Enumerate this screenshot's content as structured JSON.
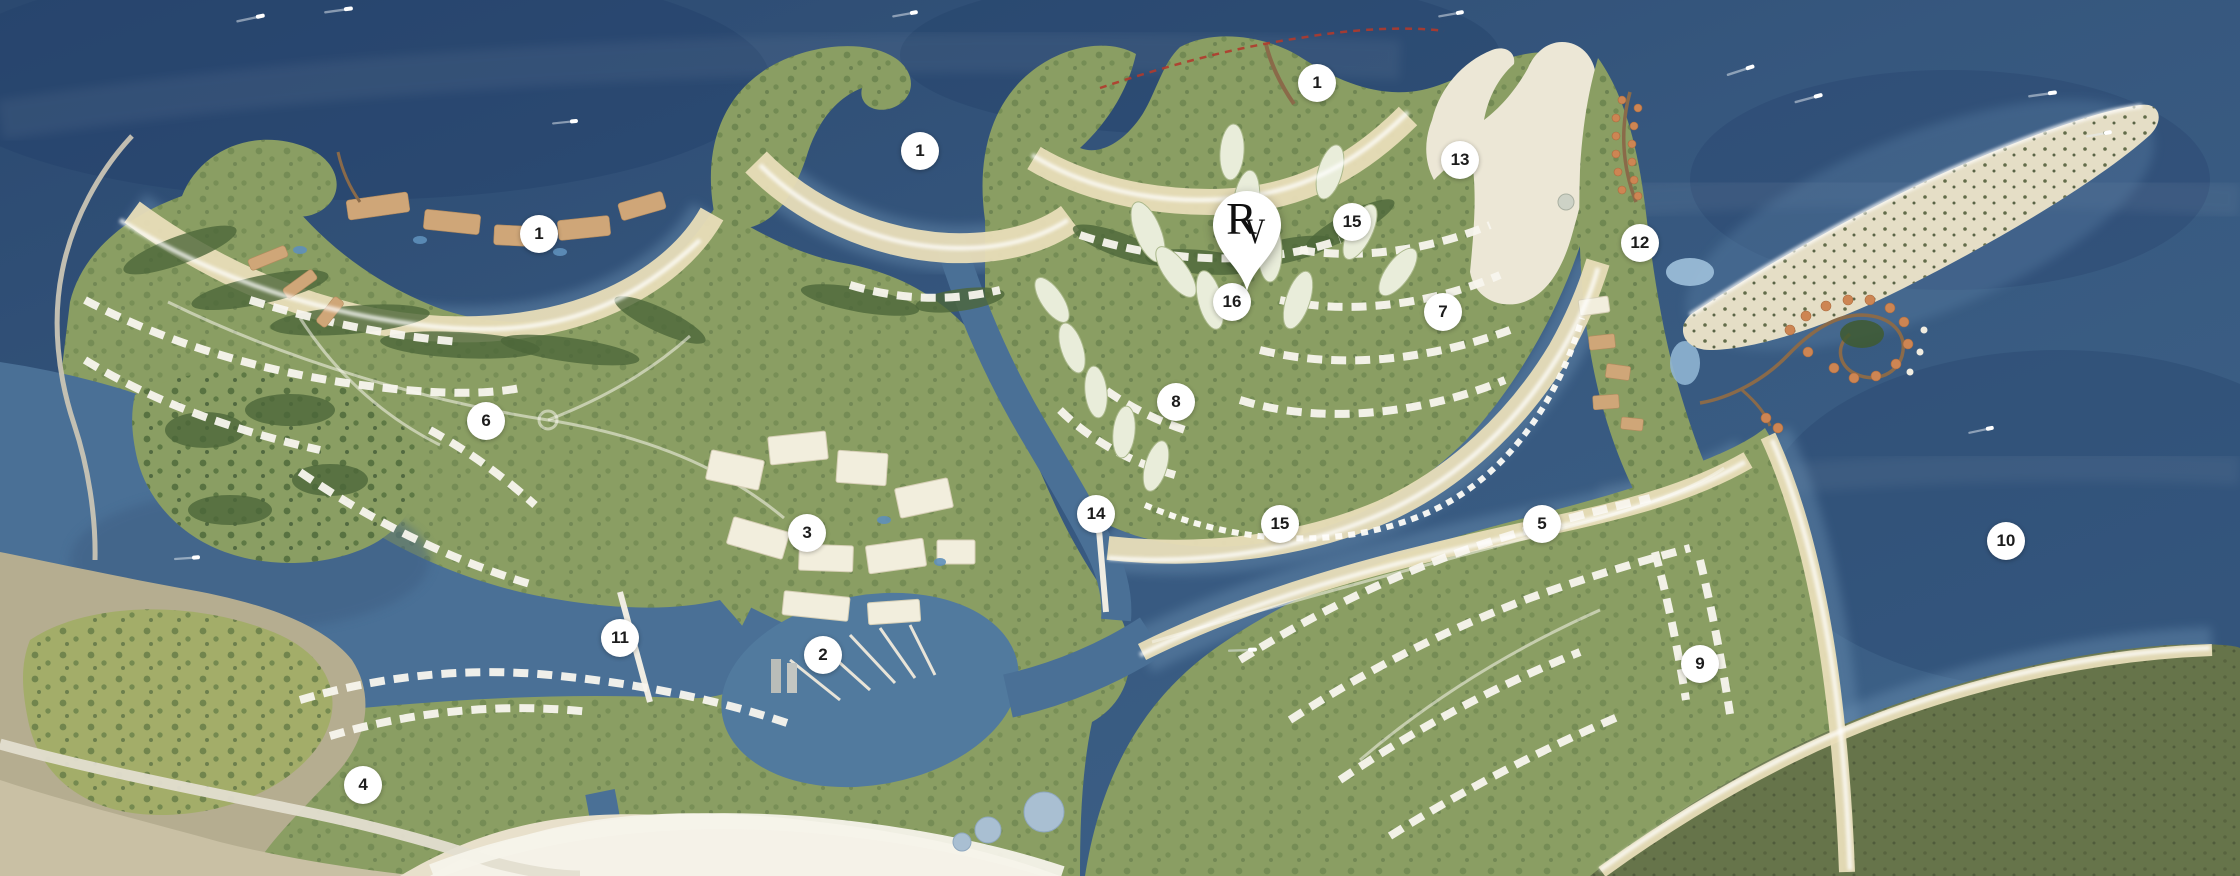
{
  "map": {
    "type": "resort-masterplan-aerial",
    "pin": {
      "monogram_primary": "R",
      "monogram_secondary": "V",
      "x_pct": 55.67,
      "y_pct": 33.45
    },
    "markers": [
      {
        "label": "1",
        "x_pct": 58.8,
        "y_pct": 9.5
      },
      {
        "label": "1",
        "x_pct": 41.07,
        "y_pct": 17.24
      },
      {
        "label": "1",
        "x_pct": 24.06,
        "y_pct": 26.71
      },
      {
        "label": "13",
        "x_pct": 65.18,
        "y_pct": 18.26
      },
      {
        "label": "15",
        "x_pct": 60.36,
        "y_pct": 25.34
      },
      {
        "label": "12",
        "x_pct": 73.21,
        "y_pct": 27.74
      },
      {
        "label": "16",
        "x_pct": 55.0,
        "y_pct": 34.47
      },
      {
        "label": "7",
        "x_pct": 64.42,
        "y_pct": 35.62
      },
      {
        "label": "8",
        "x_pct": 52.5,
        "y_pct": 45.89
      },
      {
        "label": "6",
        "x_pct": 21.7,
        "y_pct": 48.06
      },
      {
        "label": "3",
        "x_pct": 36.03,
        "y_pct": 60.84
      },
      {
        "label": "14",
        "x_pct": 48.93,
        "y_pct": 58.68
      },
      {
        "label": "15",
        "x_pct": 57.14,
        "y_pct": 59.82
      },
      {
        "label": "5",
        "x_pct": 68.84,
        "y_pct": 59.82
      },
      {
        "label": "10",
        "x_pct": 89.55,
        "y_pct": 61.76
      },
      {
        "label": "11",
        "x_pct": 27.68,
        "y_pct": 72.83
      },
      {
        "label": "2",
        "x_pct": 36.74,
        "y_pct": 74.77
      },
      {
        "label": "9",
        "x_pct": 75.89,
        "y_pct": 75.8
      },
      {
        "label": "4",
        "x_pct": 16.21,
        "y_pct": 89.61
      }
    ],
    "palette": {
      "marker_bg": "#ffffff",
      "marker_text": "#1c1c1c",
      "pin_bg": "#ffffff",
      "pin_monogram": "#101010",
      "sea_deep": "#2b4970",
      "sea_shallow": "#6a90b2",
      "lagoon": "#4a7096",
      "sand": "#e8ddb8",
      "land_green": "#8a9e63",
      "land_dark_band": "#66744a",
      "building_white": "#f8f6ee",
      "building_tan": "#cfa678",
      "overwater_villa": "#cd8553",
      "boundary_line_red": "#b03a2c"
    }
  }
}
